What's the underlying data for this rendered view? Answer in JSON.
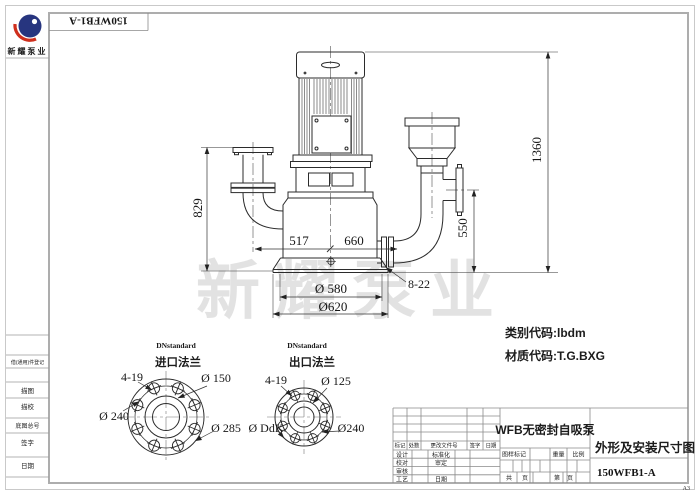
{
  "sheet": {
    "corner_number": "150WFB1-A",
    "format": "A3"
  },
  "logo": {
    "company_name": "新耀泵业"
  },
  "watermark_text": "新耀泵业",
  "left_margin": {
    "borrow_register": "借(通用)件登记",
    "tracing": "描图",
    "tracing_check": "描校",
    "base_drawing_no": "底图总号",
    "signature": "签字",
    "date": "日期"
  },
  "notes": {
    "category_code": "类别代码:lbdm",
    "material_code": "材质代码:T.G.BXG"
  },
  "dims": {
    "overall_height": "1360",
    "inlet_flange_height": "829",
    "outlet_flange_height": "550",
    "inlet_offset": "517",
    "outlet_offset": "660",
    "base_bolt_circle": "Ø 580",
    "base_diameter": "Ø620",
    "base_holes": "8-22"
  },
  "inlet_flange_view": {
    "standard": "DNstandard",
    "title": "进口法兰",
    "holes": "4-19",
    "inner_dia": "Ø 150",
    "bolt_circle": "Ø 240",
    "outer_dia": "Ø 285"
  },
  "outlet_flange_view": {
    "standard": "DNstandard",
    "title": "出口法兰",
    "holes": "4-19",
    "inner_dia": "Ø 125",
    "outer_dia": "Ø DdK",
    "bolt_circle": "Ø240"
  },
  "title_block": {
    "product_name": "WFB无密封自吸泵",
    "sheet_title": "外形及安装尺寸图",
    "drawing_number": "150WFB1-A",
    "rev_cols": {
      "mark": "标记",
      "count": "处数",
      "change_doc_no": "更改文件号",
      "signature": "签字",
      "date": "日期"
    },
    "roles": {
      "design": "设计",
      "standardization": "标准化",
      "proofread": "校对",
      "approve": "审定",
      "review": "审核",
      "process": "工艺",
      "date": "日期"
    },
    "stamp": "图样标记",
    "weight": "重量",
    "scale": "比例",
    "total_label": "共",
    "pages_label": "页",
    "number_label": "第",
    "page_label": "页",
    "format": "A3"
  }
}
